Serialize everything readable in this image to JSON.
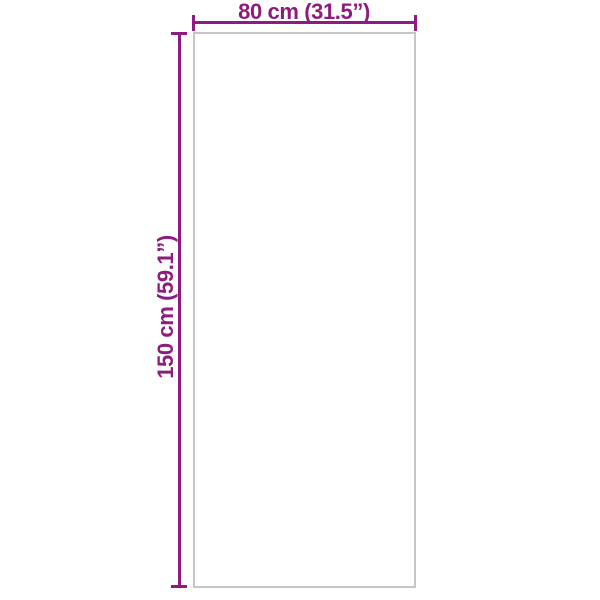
{
  "diagram": {
    "type": "product-dimension-diagram",
    "width_label": "80 cm (31.5”)",
    "height_label": "150 cm (59.1”)",
    "colors": {
      "dimension": "#8e1c80",
      "outline": "#c6c6c6",
      "background": "#ffffff"
    }
  }
}
